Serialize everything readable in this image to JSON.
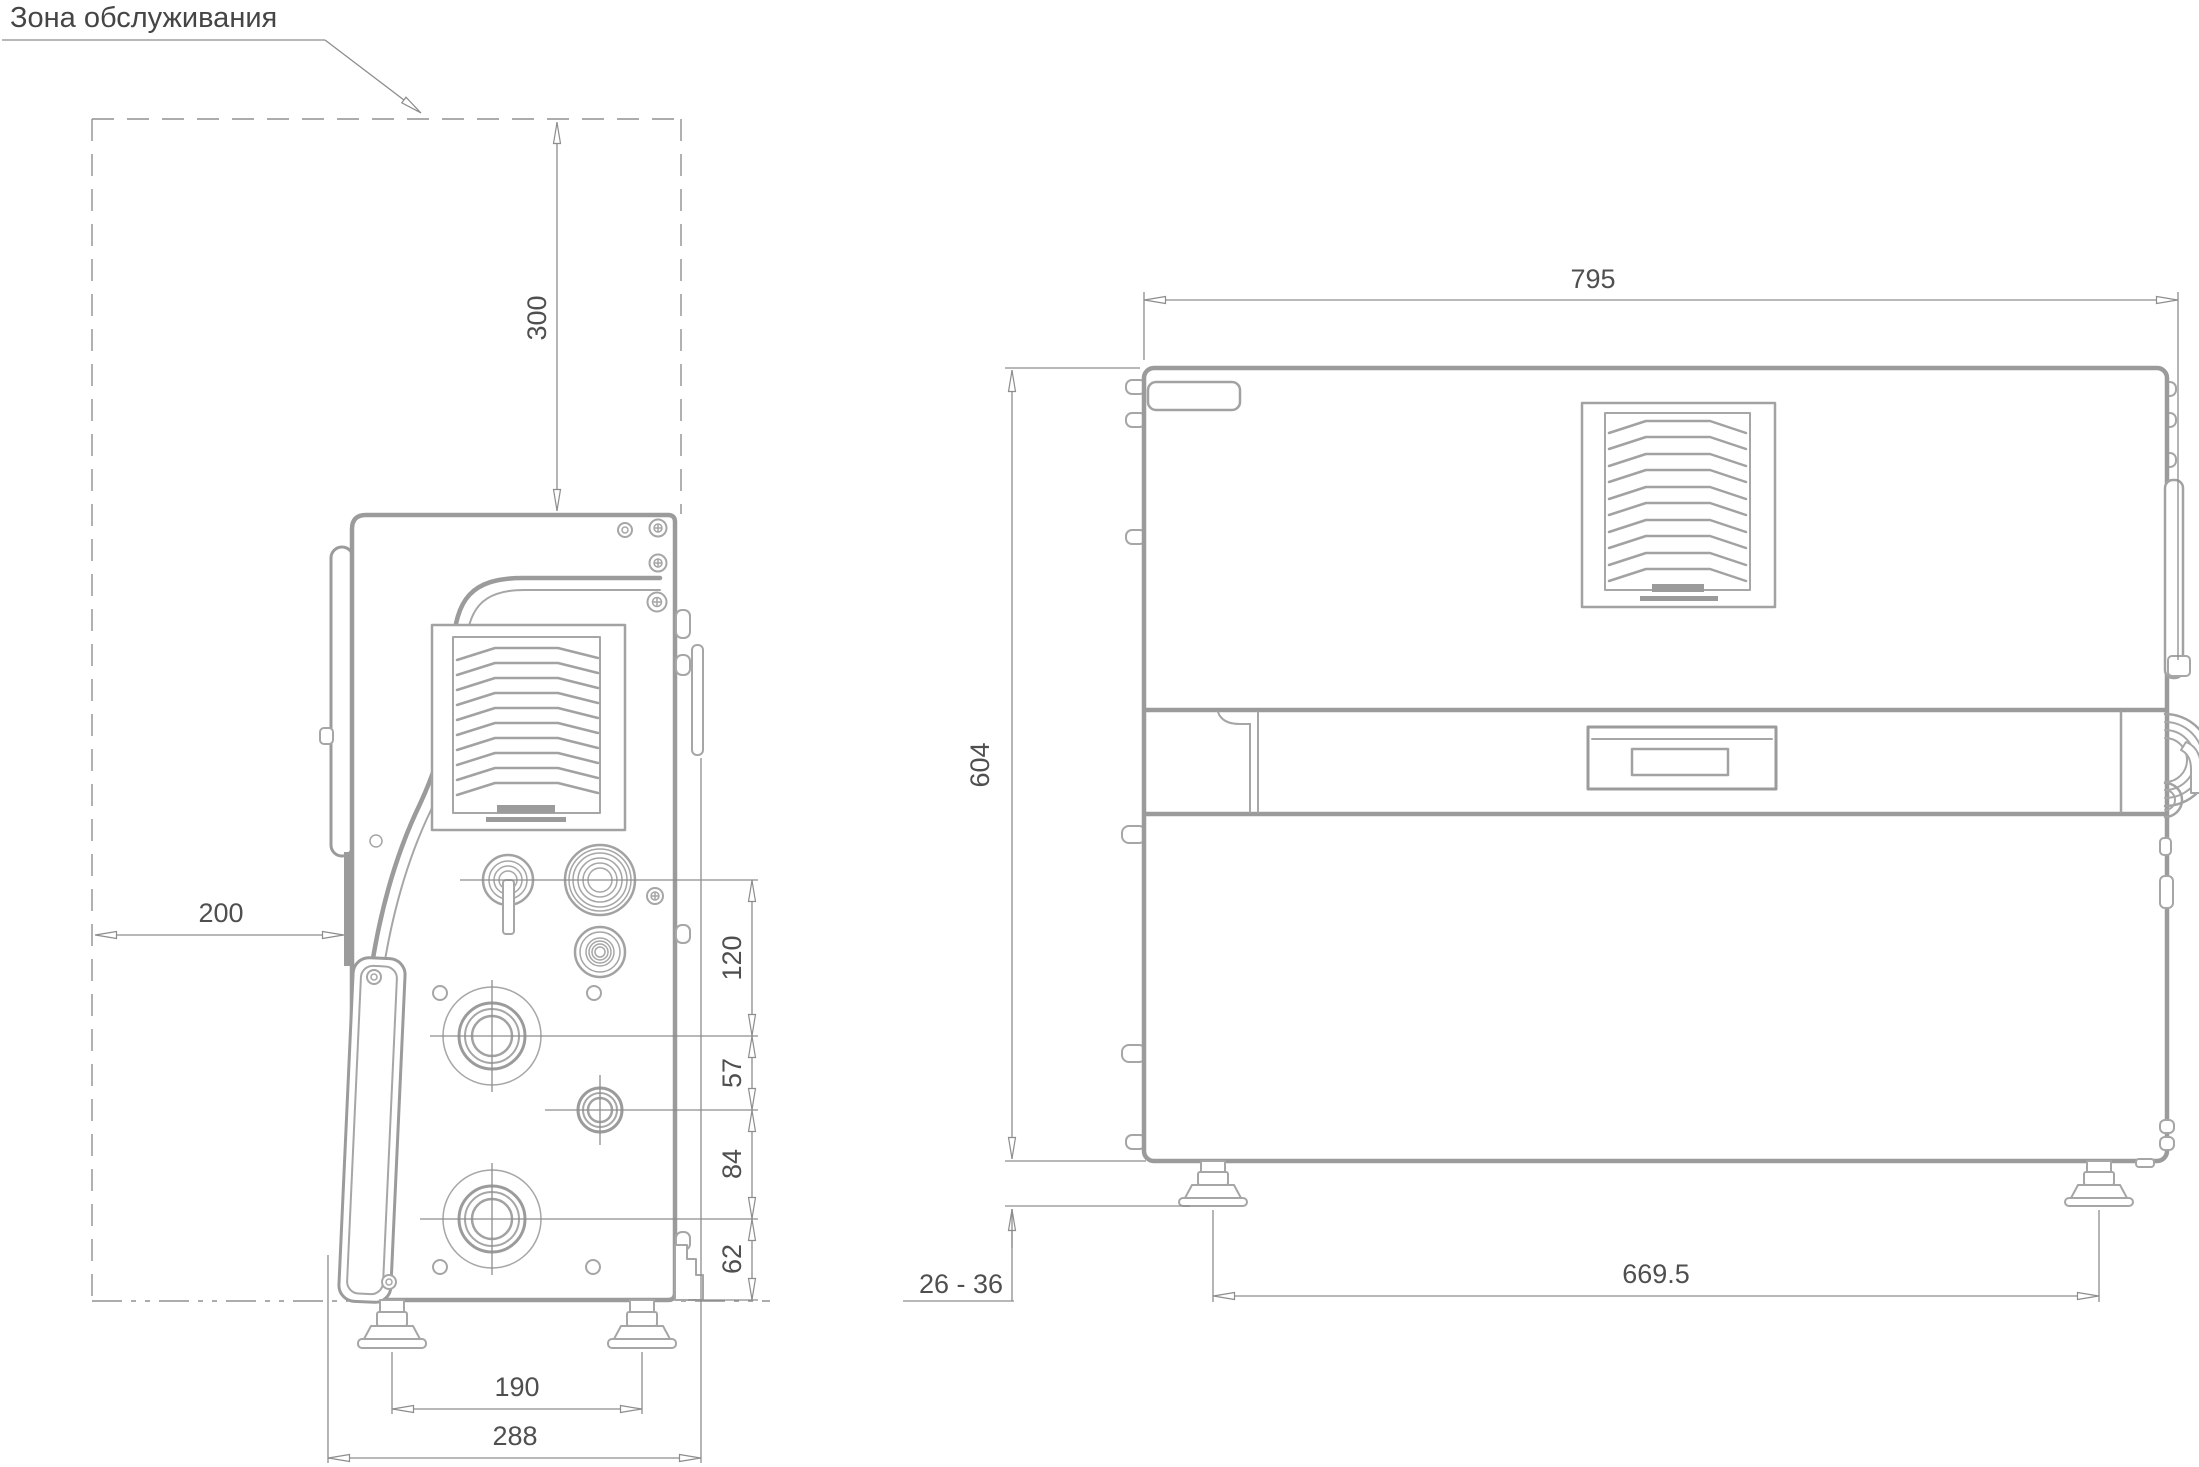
{
  "title": "Зона обслуживания",
  "views": {
    "front": {
      "label": "front-view-of-machine",
      "dims": {
        "top_clearance": "300",
        "side_clearance": "200",
        "connector_offsets": [
          "120",
          "57",
          "84",
          "62"
        ],
        "feet_spacing": "190",
        "overall_width": "288"
      }
    },
    "side": {
      "label": "side-view-of-machine",
      "dims": {
        "overall_depth": "795",
        "overall_height": "604",
        "foot_height_range": "26 - 36",
        "feet_spacing": "669.5"
      }
    }
  },
  "colors": {
    "outline": "#9b9b9b",
    "thin_line": "#a6a6a6",
    "dimension_line": "#8d8d8d",
    "text": "#4f4f4f",
    "background": "#ffffff"
  }
}
